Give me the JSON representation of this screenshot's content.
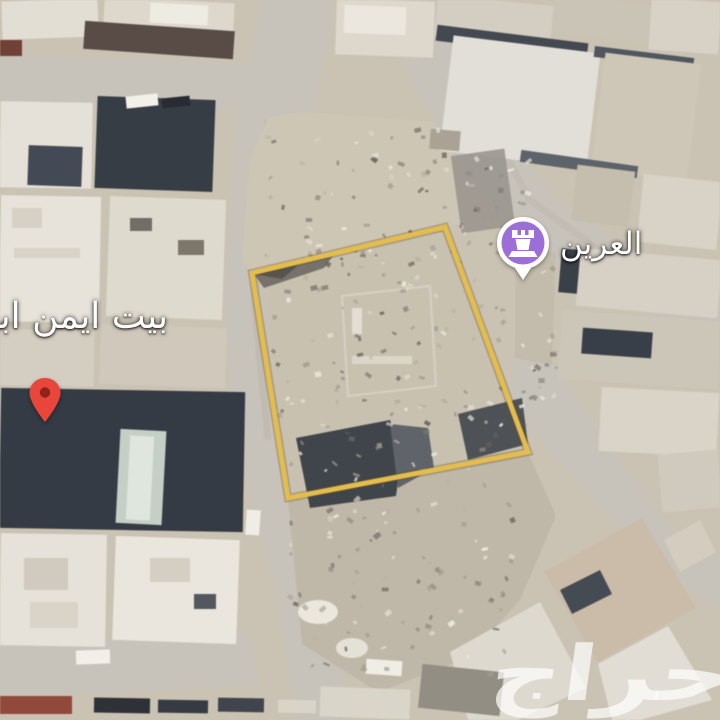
{
  "map": {
    "neighbor_label": {
      "text": "بيت ايمن ابو"
    },
    "poi": {
      "label": "العرين",
      "marker_color": "#9b6ed8",
      "icon": "rook"
    },
    "destination_pin": {
      "color": "#e8463a"
    },
    "plot": {
      "outline_color": "#e6ba3e"
    },
    "watermark": {
      "text": "حراج"
    }
  },
  "terrain": {
    "ground": "#c9c0ae",
    "road": "#c6c0b6"
  }
}
